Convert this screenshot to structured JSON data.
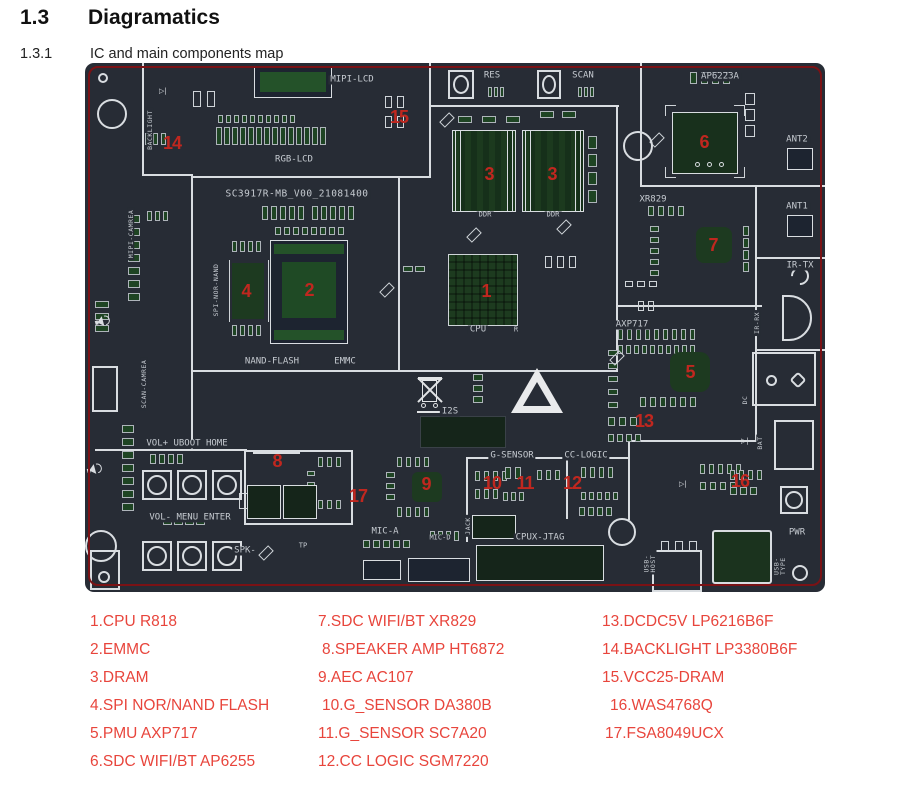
{
  "page": {
    "heading_number": "1.3",
    "heading_title": "Diagramatics",
    "sub_number": "1.3.1",
    "sub_title": "IC and main components map"
  },
  "board": {
    "title": "SC3917R-MB_V00_21081400",
    "labels": {
      "backlight": "BACKLIGHT",
      "mipi_camrea": "MIPI-CAMREA",
      "scan_camrea": "SCAN-CAMREA",
      "mipi_lcd": "MIPI-LCD",
      "rgb_lcd": "RGB-LCD",
      "spi_nor_nand": "SPI-NOR-NAND",
      "nand_flash": "NAND-FLASH",
      "emmc": "EMMC",
      "res": "RES",
      "scan": "SCAN",
      "ap6223a": "AP6223A",
      "ant2": "ANT2",
      "ant1": "ANT1",
      "xr829": "XR829",
      "ir_tx": "IR-TX",
      "ir_rx": "IR-RX",
      "ddr_left": "DDR",
      "ddr_right": "DDR",
      "cpu": "CPU",
      "cpu_r": "R",
      "axp717": "AXP717",
      "i2s": "I2S",
      "vol_up_row": "VOL+ UBOOT HOME",
      "vol_dn_row": "VOL- MENU ENTER",
      "spk": "SPK-",
      "tp": "TP",
      "mic_a": "MIC-A",
      "mic_d": "MIC-D",
      "jack": "JACK",
      "cpux_jtag": "CPUX-JTAG",
      "g_sensor": "G-SENSOR",
      "cc_logic": "CC-LOGIC",
      "dc": "DC",
      "bat": "BAT",
      "usb_host": "USB-HOST",
      "usb_type": "USB-TYPE",
      "pwr": "PWR"
    },
    "markers": {
      "m1": "1",
      "m2": "2",
      "m3a": "3",
      "m3b": "3",
      "m4": "4",
      "m5": "5",
      "m6": "6",
      "m7": "7",
      "m8": "8",
      "m9": "9",
      "m10": "10",
      "m11": "11",
      "m12": "12",
      "m13": "13",
      "m14": "14",
      "m15": "15",
      "m16": "16",
      "m17": "17"
    }
  },
  "legend": {
    "col1": [
      "1.CPU R818",
      "2.EMMC",
      "3.DRAM",
      "4.SPI NOR/NAND FLASH",
      "5.PMU AXP717",
      "6.SDC WIFI/BT AP6255"
    ],
    "col2": [
      "7.SDC WIFI/BT XR829",
      "8.SPEAKER AMP HT6872",
      "9.AEC AC107",
      "10.G_SENSOR DA380B",
      "11.G_SENSOR SC7A20",
      "12.CC LOGIC SGM7220"
    ],
    "col3": [
      "13.DCDC5V LP6216B6F",
      "14.BACKLIGHT LP3380B6F",
      "15.VCC25-DRAM",
      "16.WAS4768Q",
      "17.FSA8049UCX"
    ]
  },
  "colors": {
    "board_bg": "#272c35",
    "board_border_red": "#7a1215",
    "trace_white": "#d9dde1",
    "pad_green": "#1e4423",
    "marker_red": "#c0271f",
    "legend_red": "#e8453c"
  }
}
